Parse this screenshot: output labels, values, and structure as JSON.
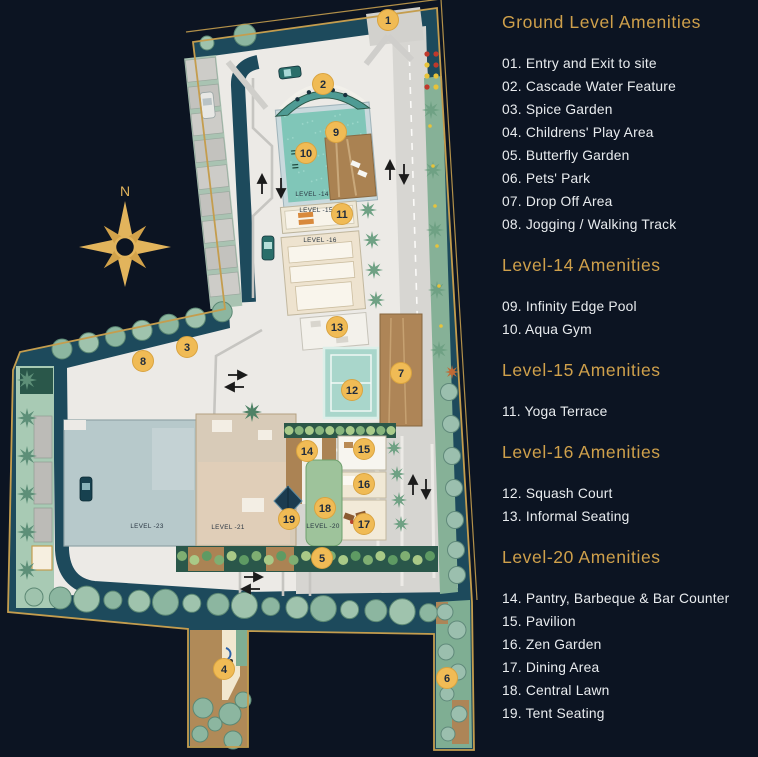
{
  "theme": {
    "background": "#0c1422",
    "heading_gold": "#cfa04b",
    "marker_gold": "#f0bb55",
    "marker_ring": "#d9a33f",
    "list_text": "#e9ecef",
    "boundary_gold": "#c49d4e"
  },
  "map": {
    "compass_label": "N",
    "markers": [
      {
        "num": "1",
        "x": 388,
        "y": 20
      },
      {
        "num": "2",
        "x": 323,
        "y": 84
      },
      {
        "num": "3",
        "x": 187,
        "y": 347
      },
      {
        "num": "4",
        "x": 224,
        "y": 669
      },
      {
        "num": "5",
        "x": 322,
        "y": 558
      },
      {
        "num": "6",
        "x": 447,
        "y": 678
      },
      {
        "num": "7",
        "x": 401,
        "y": 373
      },
      {
        "num": "8",
        "x": 143,
        "y": 361
      },
      {
        "num": "9",
        "x": 336,
        "y": 132
      },
      {
        "num": "10",
        "x": 306,
        "y": 153
      },
      {
        "num": "11",
        "x": 342,
        "y": 214
      },
      {
        "num": "12",
        "x": 352,
        "y": 390
      },
      {
        "num": "13",
        "x": 337,
        "y": 327
      },
      {
        "num": "14",
        "x": 307,
        "y": 451
      },
      {
        "num": "15",
        "x": 364,
        "y": 449
      },
      {
        "num": "16",
        "x": 364,
        "y": 484
      },
      {
        "num": "17",
        "x": 364,
        "y": 524
      },
      {
        "num": "18",
        "x": 325,
        "y": 508
      },
      {
        "num": "19",
        "x": 289,
        "y": 519
      }
    ],
    "level_labels": [
      {
        "text": "LEVEL -14",
        "x": 312,
        "y": 196
      },
      {
        "text": "LEVEL -15",
        "x": 316,
        "y": 212
      },
      {
        "text": "LEVEL -16",
        "x": 320,
        "y": 242
      },
      {
        "text": "LEVEL -23",
        "x": 147,
        "y": 528
      },
      {
        "text": "LEVEL -21",
        "x": 228,
        "y": 529
      },
      {
        "text": "LEVEL -20",
        "x": 323,
        "y": 528
      }
    ]
  },
  "legend": {
    "sections": [
      {
        "title": "Ground Level Amenities",
        "items": [
          {
            "num": "01.",
            "label": "Entry and Exit to site"
          },
          {
            "num": "02.",
            "label": "Cascade Water Feature"
          },
          {
            "num": "03.",
            "label": "Spice Garden"
          },
          {
            "num": "04.",
            "label": "Childrens' Play Area"
          },
          {
            "num": "05.",
            "label": "Butterfly Garden"
          },
          {
            "num": "06.",
            "label": "Pets' Park"
          },
          {
            "num": "07.",
            "label": "Drop Off Area"
          },
          {
            "num": "08.",
            "label": "Jogging / Walking Track"
          }
        ]
      },
      {
        "title": "Level-14 Amenities",
        "items": [
          {
            "num": "09.",
            "label": "Infinity Edge Pool"
          },
          {
            "num": "10.",
            "label": "Aqua Gym"
          }
        ]
      },
      {
        "title": "Level-15 Amenities",
        "items": [
          {
            "num": "11.",
            "label": "Yoga Terrace"
          }
        ]
      },
      {
        "title": "Level-16 Amenities",
        "items": [
          {
            "num": "12.",
            "label": "Squash Court"
          },
          {
            "num": "13.",
            "label": "Informal Seating"
          }
        ]
      },
      {
        "title": "Level-20 Amenities",
        "items": [
          {
            "num": "14.",
            "label": "Pantry, Barbeque & Bar Counter"
          },
          {
            "num": "15.",
            "label": "Pavilion"
          },
          {
            "num": "16.",
            "label": "Zen Garden"
          },
          {
            "num": "17.",
            "label": "Dining Area"
          },
          {
            "num": "18.",
            "label": "Central Lawn"
          },
          {
            "num": "19.",
            "label": "Tent Seating"
          }
        ]
      }
    ]
  }
}
